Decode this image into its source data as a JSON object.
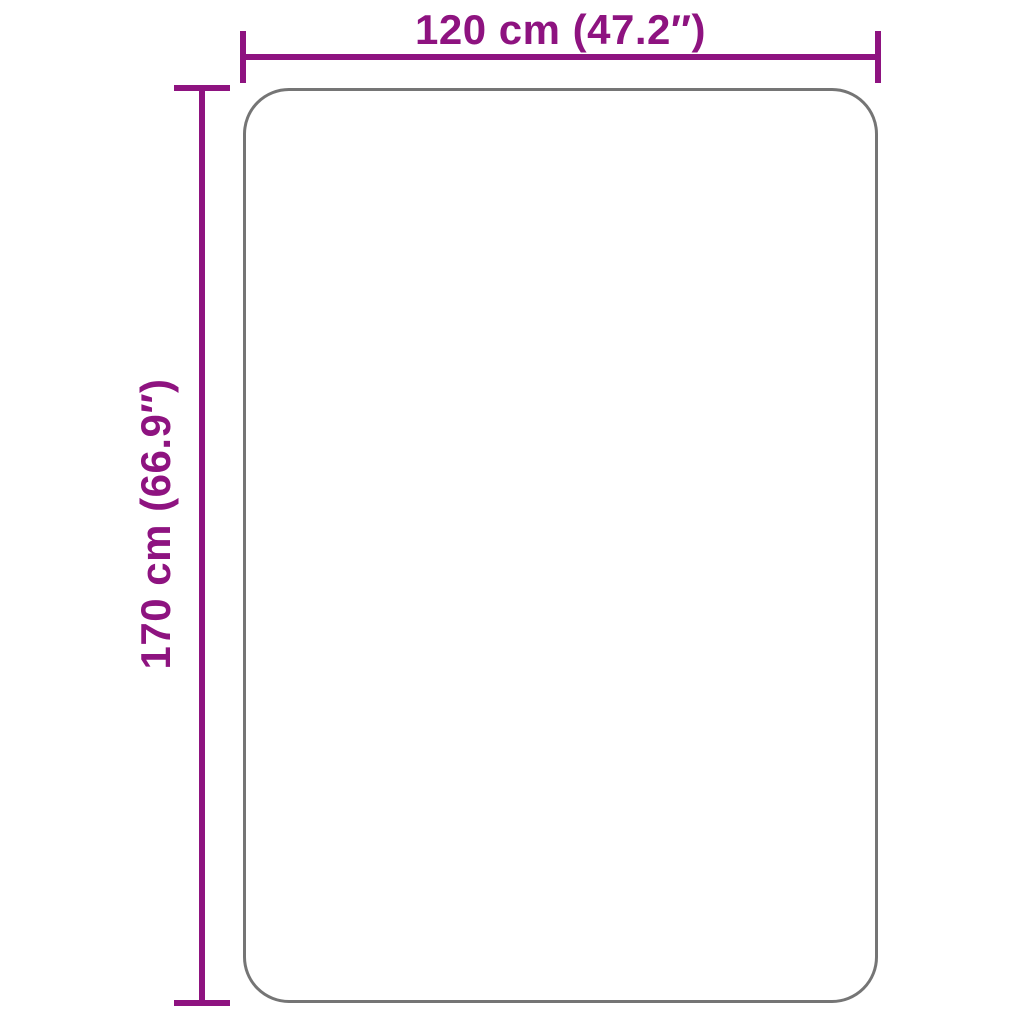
{
  "title": "Product dimension diagram",
  "colors": {
    "accent": "#8E1380",
    "outline": "#757575",
    "bg": "#FFFFFF"
  },
  "dimensions": {
    "width": {
      "label": "120 cm (47.2″)"
    },
    "height": {
      "label": "170 cm (66.9″)"
    }
  }
}
